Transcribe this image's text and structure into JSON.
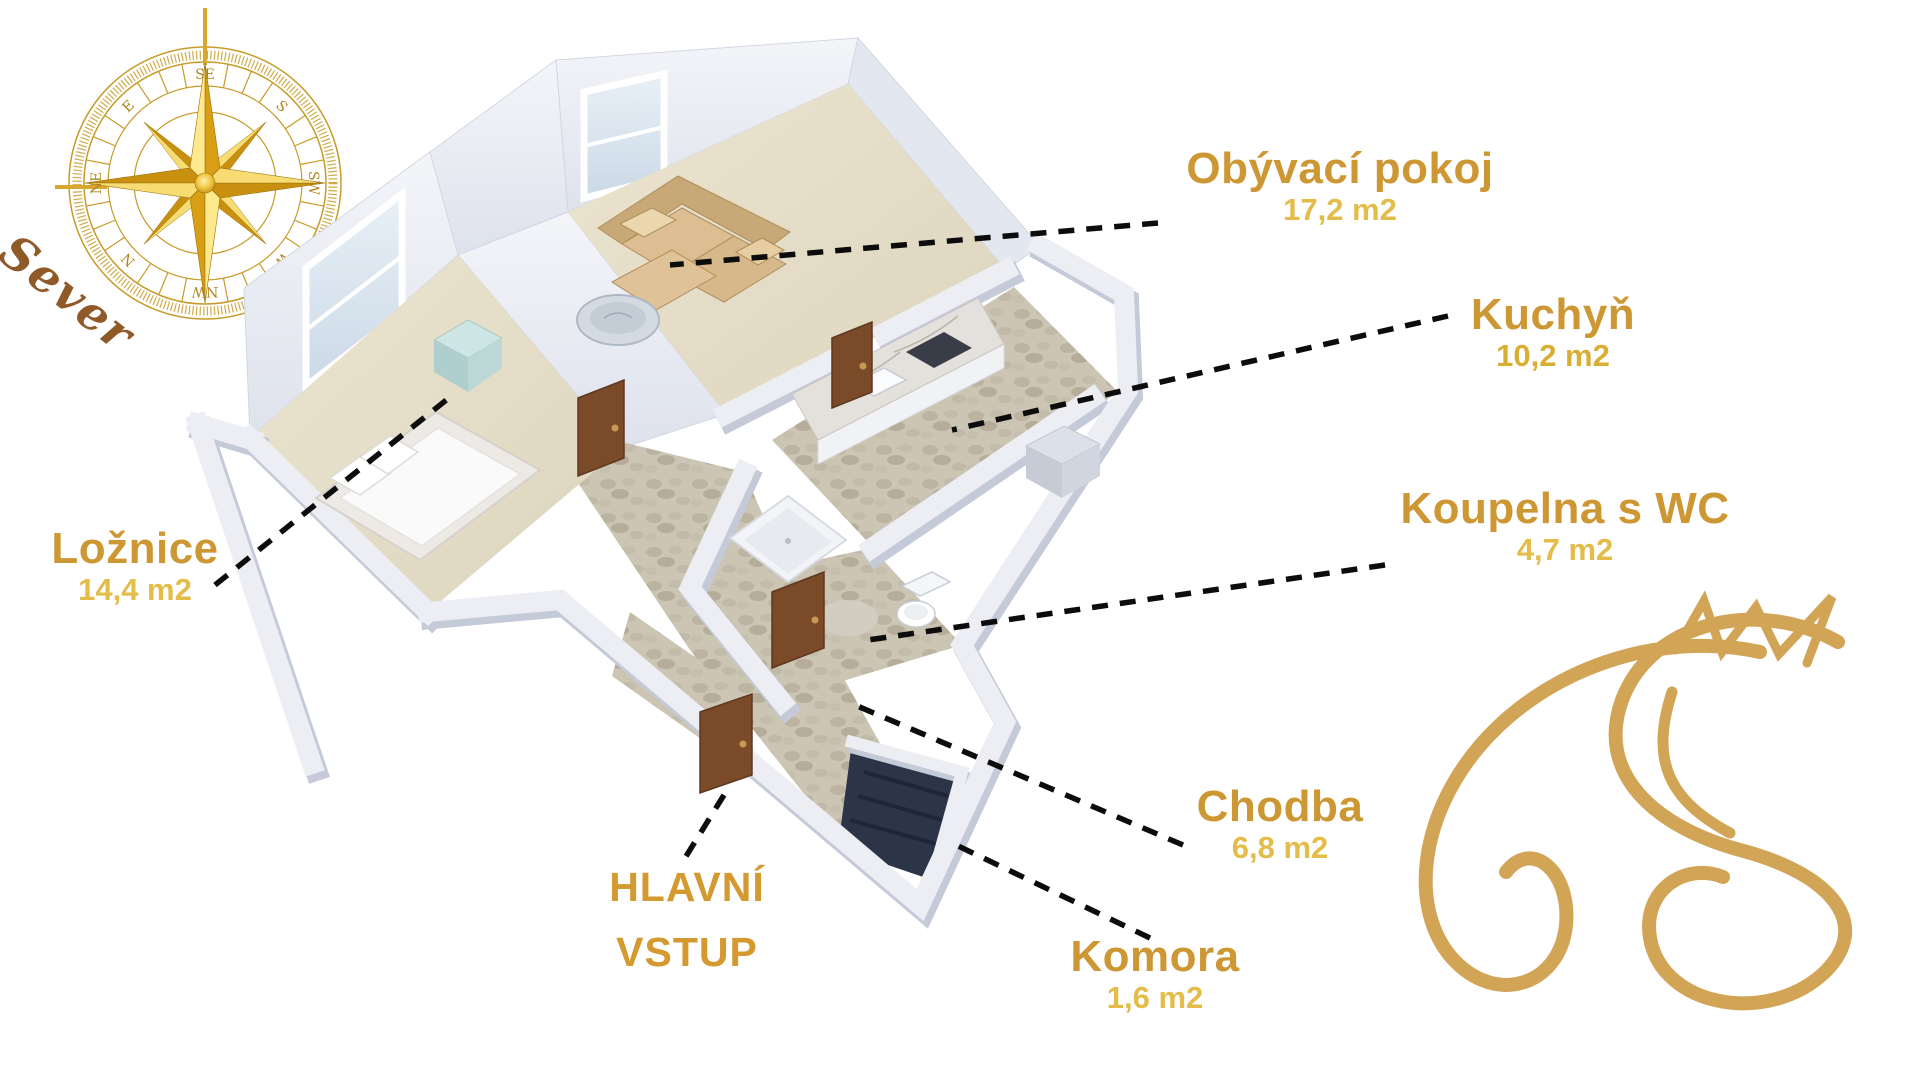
{
  "compass": {
    "north_label": "Sever",
    "directions": [
      "SE",
      "S",
      "SW",
      "W",
      "NW",
      "N",
      "NE",
      "E"
    ]
  },
  "rooms": [
    {
      "id": "obyvaci-pokoj",
      "name": "Obývací pokoj",
      "area": "17,2 m2"
    },
    {
      "id": "kuchyn",
      "name": "Kuchyň",
      "area": "10,2 m2"
    },
    {
      "id": "koupelna-s-wc",
      "name": "Koupelna s WC",
      "area": "4,7 m2"
    },
    {
      "id": "loznice",
      "name": "Ložnice",
      "area": "14,4 m2"
    },
    {
      "id": "chodba",
      "name": "Chodba",
      "area": "6,8 m2"
    },
    {
      "id": "komora",
      "name": "Komora",
      "area": "1,6 m2"
    }
  ],
  "entrance": {
    "line1": "HLAVNÍ",
    "line2": "VSTUP"
  },
  "colors": {
    "room_label": "#CD9733",
    "room_area": "#E3BC4A",
    "entrance_label": "#D4992F",
    "leader_line": "#0C0C0C",
    "compass_gold": "#D9A62E",
    "sever_brown": "#8F5A28",
    "logo_gold": "#D2A456"
  }
}
